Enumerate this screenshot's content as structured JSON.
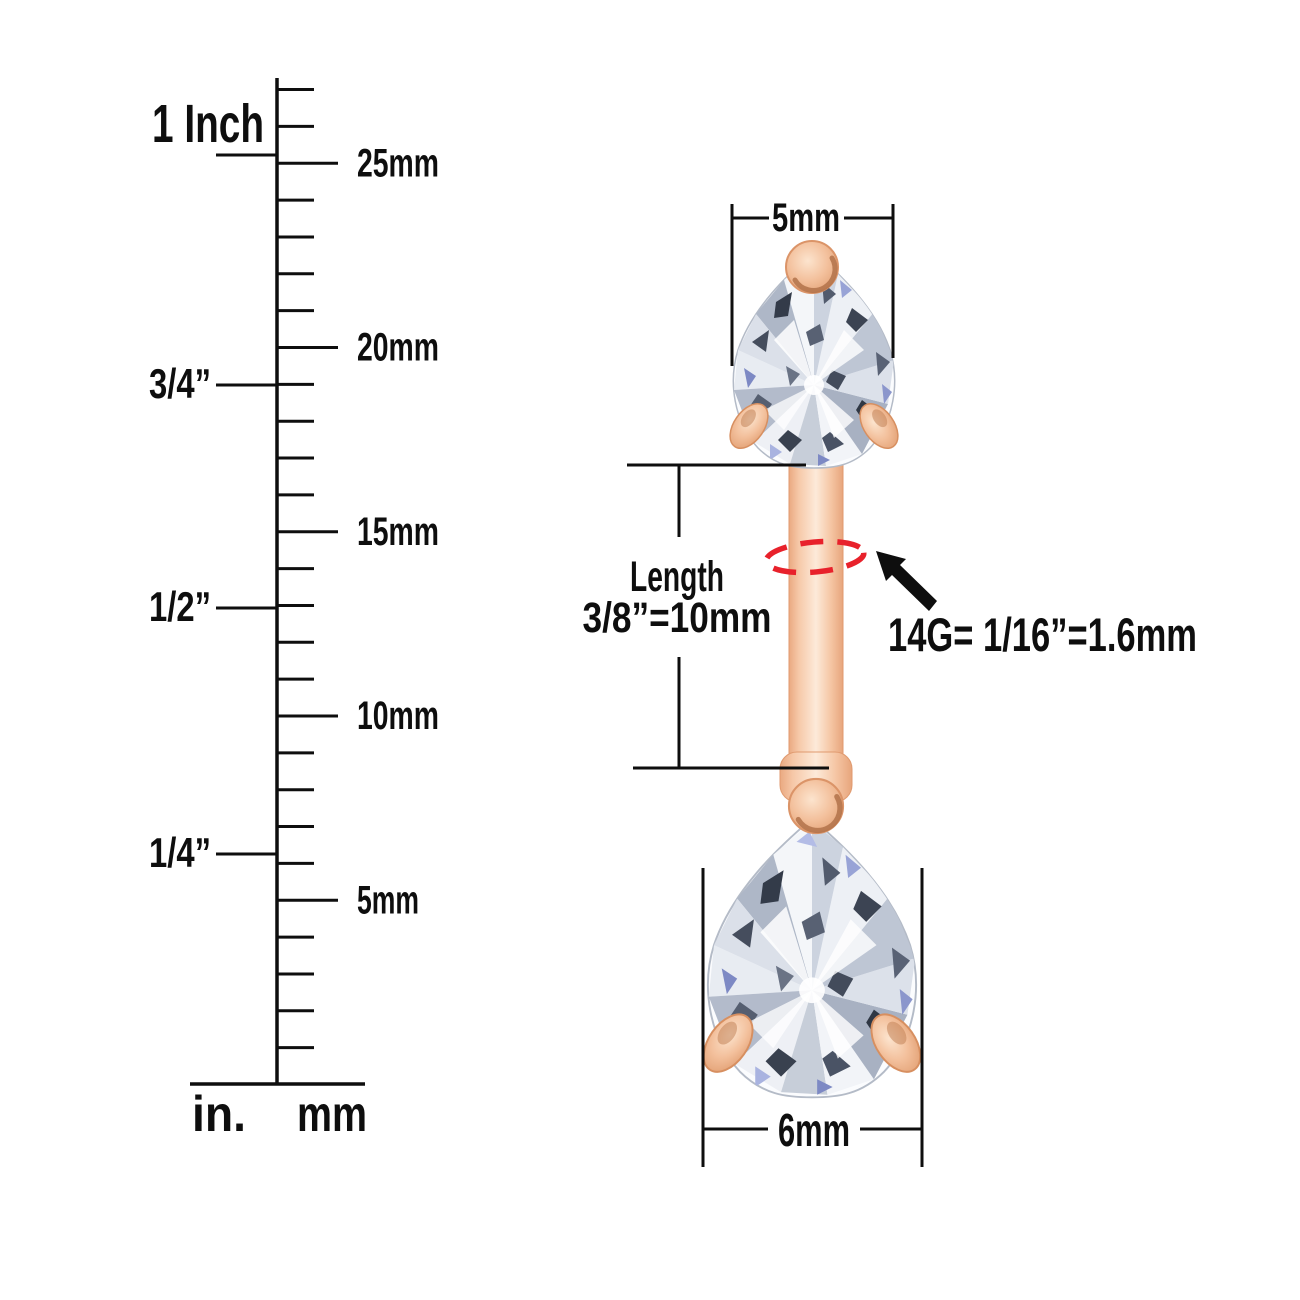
{
  "ruler": {
    "mm_tick_count": 27,
    "mm_marks": [
      {
        "label": "25mm",
        "mm": 25
      },
      {
        "label": "20mm",
        "mm": 20
      },
      {
        "label": "15mm",
        "mm": 15
      },
      {
        "label": "10mm",
        "mm": 10
      },
      {
        "label": "5mm",
        "mm": 5
      }
    ],
    "inch_marks": [
      {
        "label": "1 Inch",
        "y": 155,
        "placement": "above-line"
      },
      {
        "label": "3/4”",
        "y": 385,
        "placement": "on-line"
      },
      {
        "label": "1/2”",
        "y": 608,
        "placement": "on-line"
      },
      {
        "label": "1/4”",
        "y": 854,
        "placement": "on-line"
      }
    ],
    "unit_labels": {
      "inch": "in.",
      "mm": "mm"
    }
  },
  "annotations": {
    "top_gem_width": "5mm",
    "bottom_gem_width": "6mm",
    "length_title": "Length",
    "length_value": "3/8”=10mm",
    "gauge_text": "14G= 1/16”=1.6mm"
  },
  "colors": {
    "line": "#0e0e0e",
    "gauge_dash_red": "#e8212b",
    "rose_gold": "#f0b38c",
    "rose_gold_light": "#fdead9",
    "rose_gold_dark": "#d7905f",
    "gem_outline": "#b4bbc7",
    "gem_facet_dark": "#39414f",
    "gem_facet_blue": "#7d89c4"
  }
}
